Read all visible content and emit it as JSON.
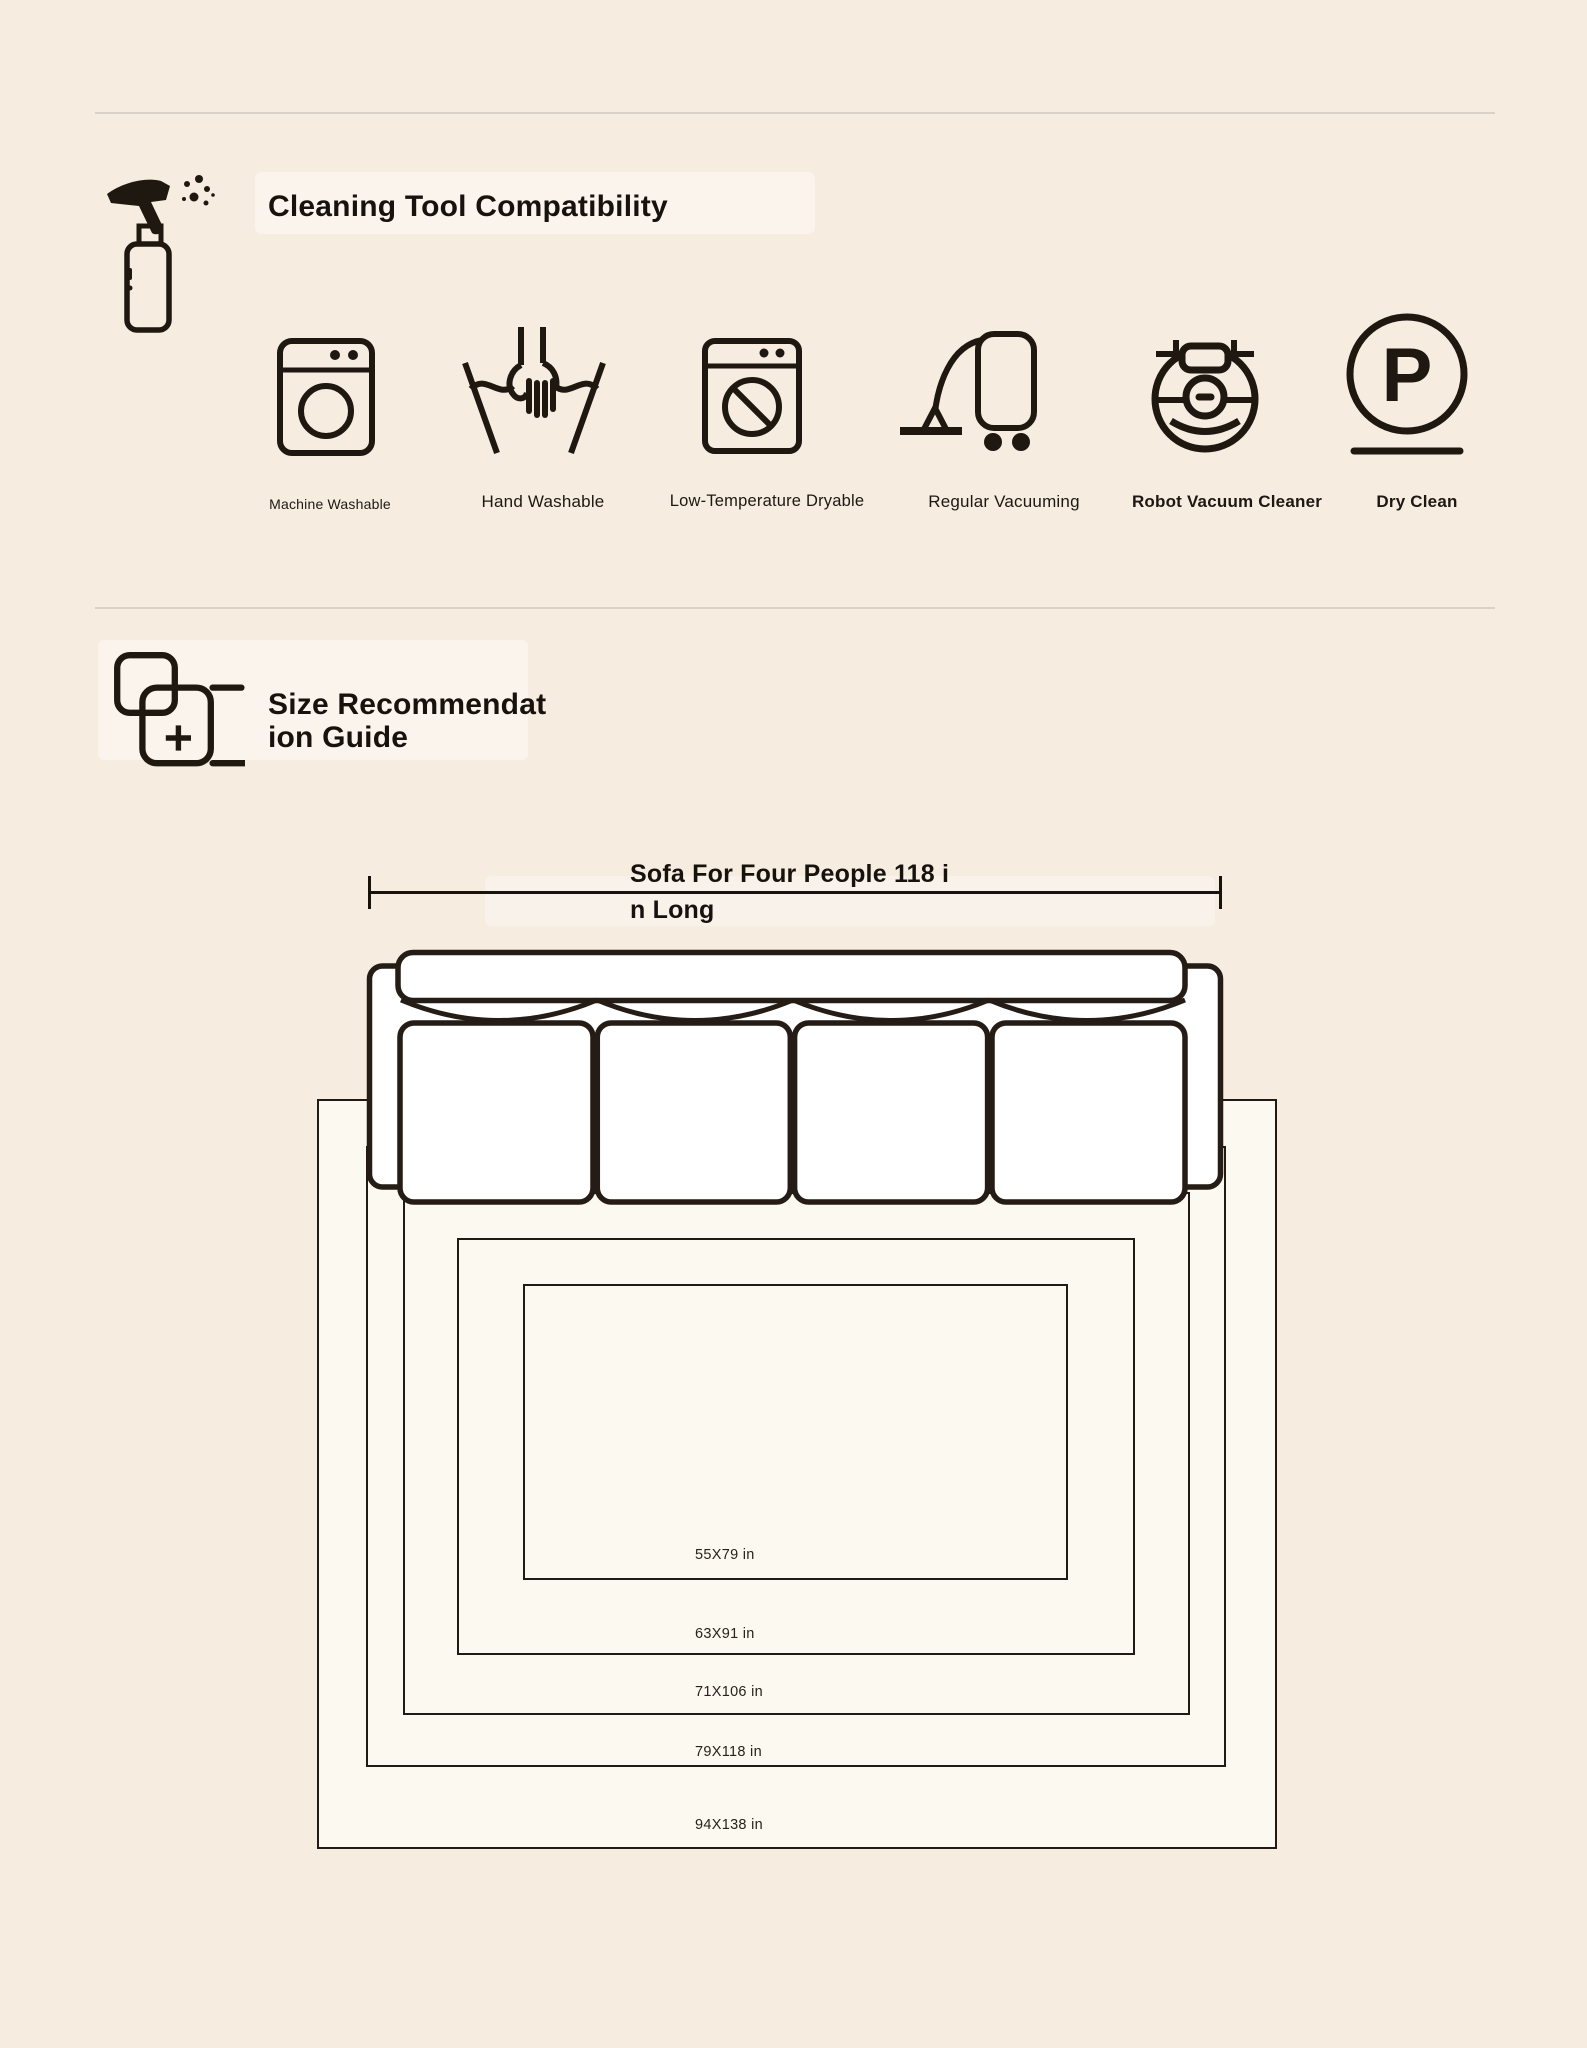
{
  "colors": {
    "page_background": "#f6ecdf",
    "rug_fill": "#fcf9f1",
    "line_dark": "#1f1811",
    "sofa_fill": "#ffffff",
    "divider": "#d9d2c7"
  },
  "cleaning_section": {
    "title": "Cleaning Tool Compatibility",
    "section_icon": "spray-bottle-icon",
    "items": [
      {
        "icon": "washing-machine-icon",
        "label": "Machine Washable"
      },
      {
        "icon": "hand-wash-icon",
        "label": "Hand Washable"
      },
      {
        "icon": "dryer-icon",
        "label": "Low-Temperature Dryable"
      },
      {
        "icon": "vacuum-icon",
        "label": "Regular Vacuuming"
      },
      {
        "icon": "robot-vacuum-icon",
        "label": "Robot Vacuum Cleaner"
      },
      {
        "icon": "dry-clean-icon",
        "label": "Dry Clean",
        "letter": "P"
      }
    ]
  },
  "size_guide": {
    "section_icon": "size-compare-icon",
    "title_line1": "Size Recommendat",
    "title_line2": "ion Guide",
    "sofa_label_line1": "Sofa For Four People 118 i",
    "sofa_label_line2": "n Long",
    "rug_sizes": [
      "55X79 in",
      "63X91 in",
      "71X106 in",
      "79X118 in",
      "94X138 in"
    ]
  }
}
